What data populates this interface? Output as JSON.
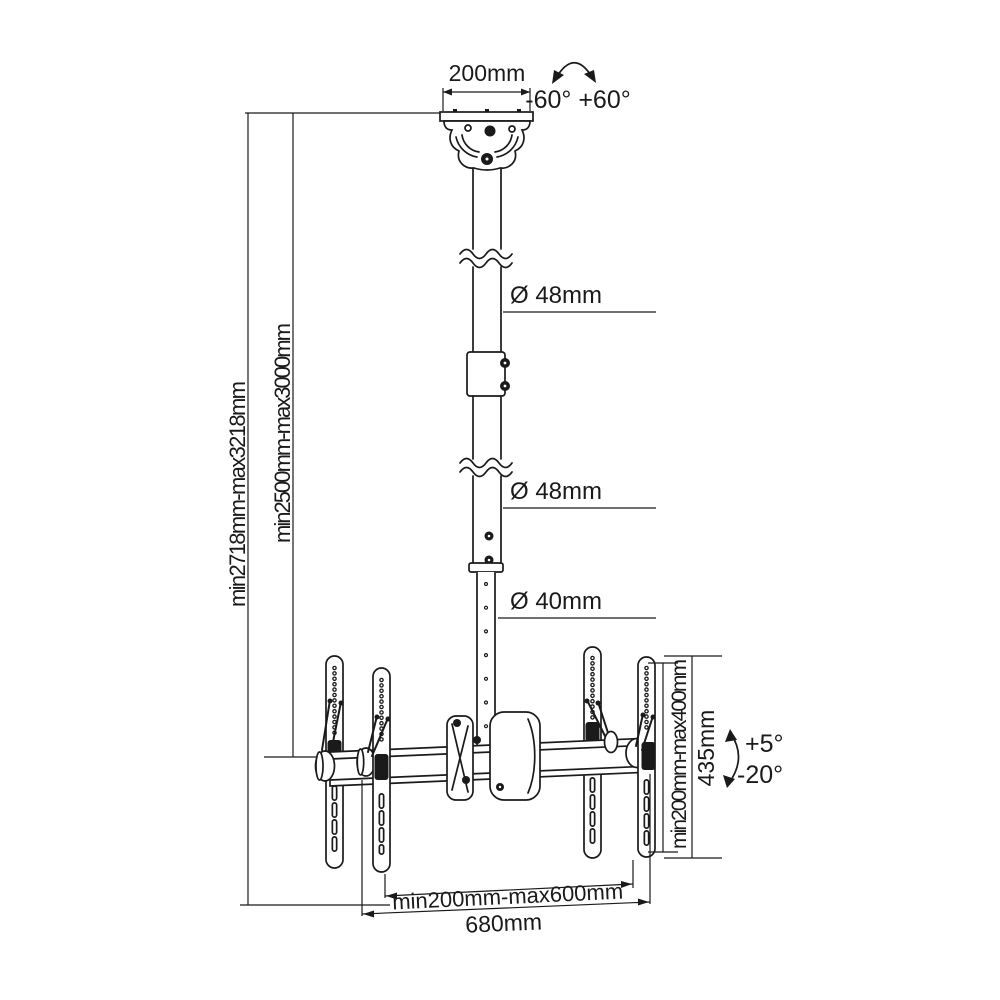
{
  "diagram": {
    "type": "technical-dimension-drawing",
    "subject": "dual-screen telescopic ceiling TV mount",
    "line_color": "#1a1a1a",
    "background": "#ffffff"
  },
  "labels": {
    "ceiling_plate_width": "200mm",
    "swivel_range": "-60° +60°",
    "upper_pole_diameter": "Ø 48mm",
    "middle_pole_diameter": "Ø 48mm",
    "lower_pole_diameter": "Ø 40mm",
    "total_height_range": "min2718mm-max3218mm",
    "drop_height_range": "min2500mm-max3000mm",
    "vesa_height_range": "min200mm-max400mm",
    "bracket_height": "435mm",
    "tilt_up": "+5°",
    "tilt_down": "-20°",
    "vesa_width_range": "min200mm-max600mm",
    "crossbar_width": "680mm"
  }
}
